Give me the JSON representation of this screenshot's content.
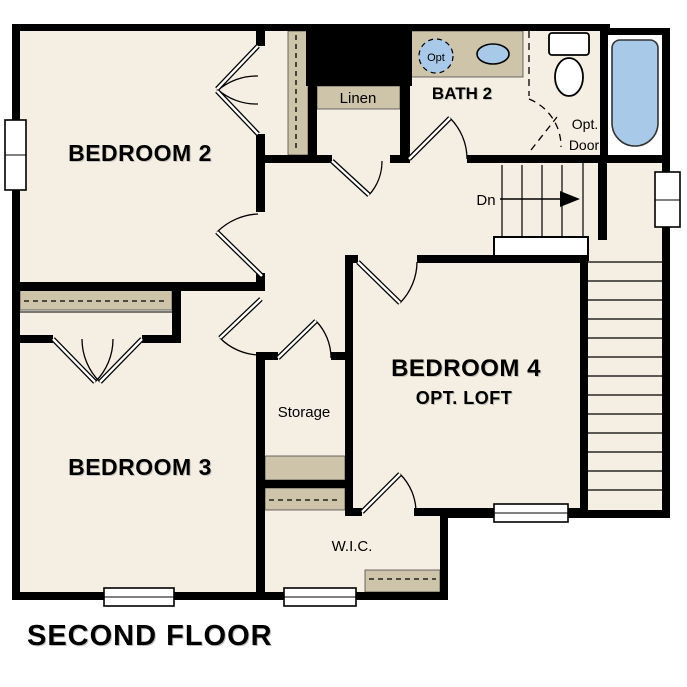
{
  "title": "SECOND FLOOR",
  "colors": {
    "background": "#ffffff",
    "floor": "#f5eee2",
    "shelf": "#cec4a9",
    "wall": "#000000",
    "fixture": "#a9c9e9"
  },
  "labels": {
    "bedroom2": "BEDROOM 2",
    "bedroom3": "BEDROOM 3",
    "bedroom4": "BEDROOM 4",
    "bedroom4_sub": "OPT. LOFT",
    "bath2": "BATH 2",
    "linen": "Linen",
    "storage": "Storage",
    "wic": "W.I.C.",
    "stairs_direction": "Dn",
    "opt_door_line1": "Opt.",
    "opt_door_line2": "Door",
    "opt_sink": "Opt"
  }
}
